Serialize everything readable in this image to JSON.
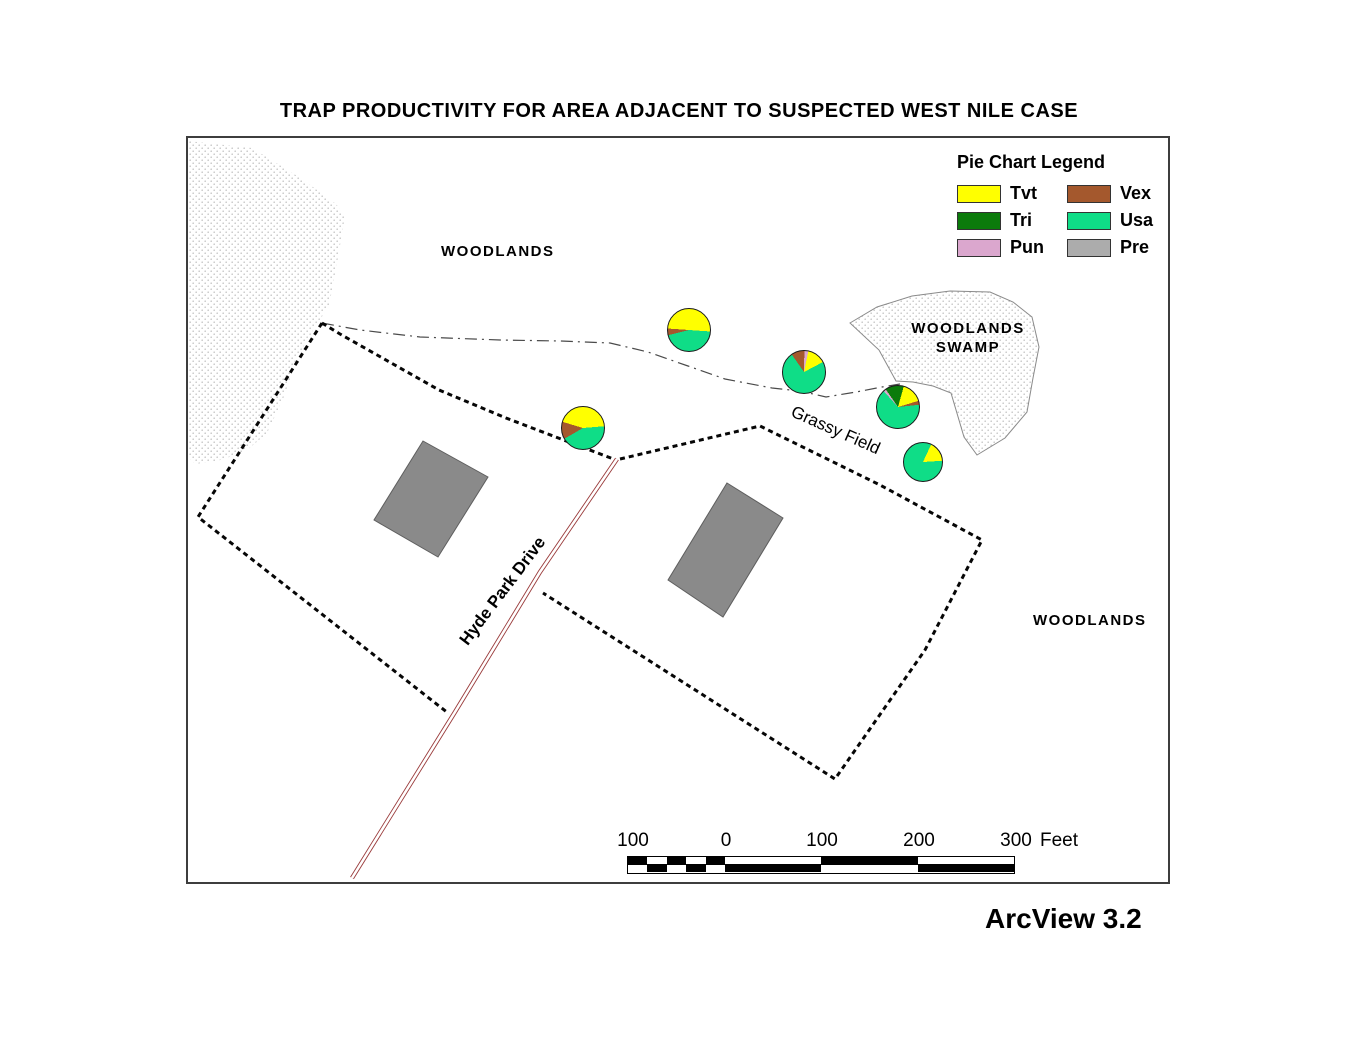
{
  "title": "TRAP PRODUCTIVITY FOR AREA ADJACENT TO SUSPECTED WEST NILE CASE",
  "credit": "ArcView 3.2",
  "labels": {
    "woodlands_top": "WOODLANDS",
    "woodlands_right": "WOODLANDS",
    "swamp_line1": "WOODLANDS",
    "swamp_line2": "SWAMP",
    "grassy_field": "Grassy Field",
    "road": "Hyde Park Drive"
  },
  "legend": {
    "title": "Pie Chart Legend",
    "items": [
      {
        "label": "Tvt",
        "color": "#FFFF00"
      },
      {
        "label": "Vex",
        "color": "#A4582D"
      },
      {
        "label": "Tri",
        "color": "#0B7B0B"
      },
      {
        "label": "Usa",
        "color": "#0FDD87"
      },
      {
        "label": "Pun",
        "color": "#DBA7CE"
      },
      {
        "label": "Pre",
        "color": "#ACACAC"
      }
    ]
  },
  "map_colors": {
    "building": "#8A8A8A",
    "building_outline": "#5E5E5E",
    "road": "#9A3B3B",
    "stipple_dot": "#C6C6C6",
    "parcel_line": "#060606"
  },
  "scale_bar": {
    "labels": [
      "100",
      "0",
      "100",
      "200",
      "300"
    ],
    "unit": "Feet",
    "left_width": 97,
    "right_width": 289,
    "left_subdivisions": 5,
    "right_divisions": 3
  },
  "pies": [
    {
      "cx": 583,
      "cy": 428,
      "r": 22,
      "start": 240,
      "slices": [
        [
          "Vex",
          13
        ],
        [
          "Tvt",
          44
        ],
        [
          "Usa",
          43
        ]
      ]
    },
    {
      "cx": 689,
      "cy": 330,
      "r": 22,
      "start": 256,
      "slices": [
        [
          "Vex",
          5
        ],
        [
          "Tvt",
          50
        ],
        [
          "Usa",
          45
        ]
      ]
    },
    {
      "cx": 804,
      "cy": 372,
      "r": 22,
      "start": 325,
      "slices": [
        [
          "Vex",
          10
        ],
        [
          "Pun",
          3
        ],
        [
          "Tvt",
          14
        ],
        [
          "Usa",
          73
        ]
      ]
    },
    {
      "cx": 898,
      "cy": 407,
      "r": 22,
      "start": 318,
      "slices": [
        [
          "Pun",
          2
        ],
        [
          "Tri",
          14
        ],
        [
          "Tvt",
          16
        ],
        [
          "Vex",
          3
        ],
        [
          "Usa",
          65
        ]
      ]
    },
    {
      "cx": 923,
      "cy": 462,
      "r": 20,
      "start": 25,
      "slices": [
        [
          "Tvt",
          17
        ],
        [
          "Usa",
          83
        ]
      ]
    }
  ],
  "chart_data": {
    "type": "pie",
    "title": "TRAP PRODUCTIVITY FOR AREA ADJACENT TO SUSPECTED WEST NILE CASE",
    "description": "Species composition (percent, estimated) of mosquito trap catches at five trap locations shown as pie charts on the map",
    "legend_title": "Pie Chart Legend",
    "species": [
      "Tvt",
      "Tri",
      "Pun",
      "Vex",
      "Usa",
      "Pre"
    ],
    "traps": [
      {
        "trap": 1,
        "map_xy": [
          583,
          428
        ],
        "values": {
          "Tvt": 44,
          "Vex": 13,
          "Usa": 43
        }
      },
      {
        "trap": 2,
        "map_xy": [
          689,
          330
        ],
        "values": {
          "Tvt": 50,
          "Vex": 5,
          "Usa": 45
        }
      },
      {
        "trap": 3,
        "map_xy": [
          804,
          372
        ],
        "values": {
          "Tvt": 14,
          "Vex": 10,
          "Pun": 3,
          "Usa": 73
        }
      },
      {
        "trap": 4,
        "map_xy": [
          898,
          407
        ],
        "values": {
          "Tvt": 16,
          "Tri": 14,
          "Pun": 2,
          "Vex": 3,
          "Usa": 65
        }
      },
      {
        "trap": 5,
        "map_xy": [
          923,
          462
        ],
        "values": {
          "Tvt": 17,
          "Usa": 83
        }
      }
    ]
  }
}
